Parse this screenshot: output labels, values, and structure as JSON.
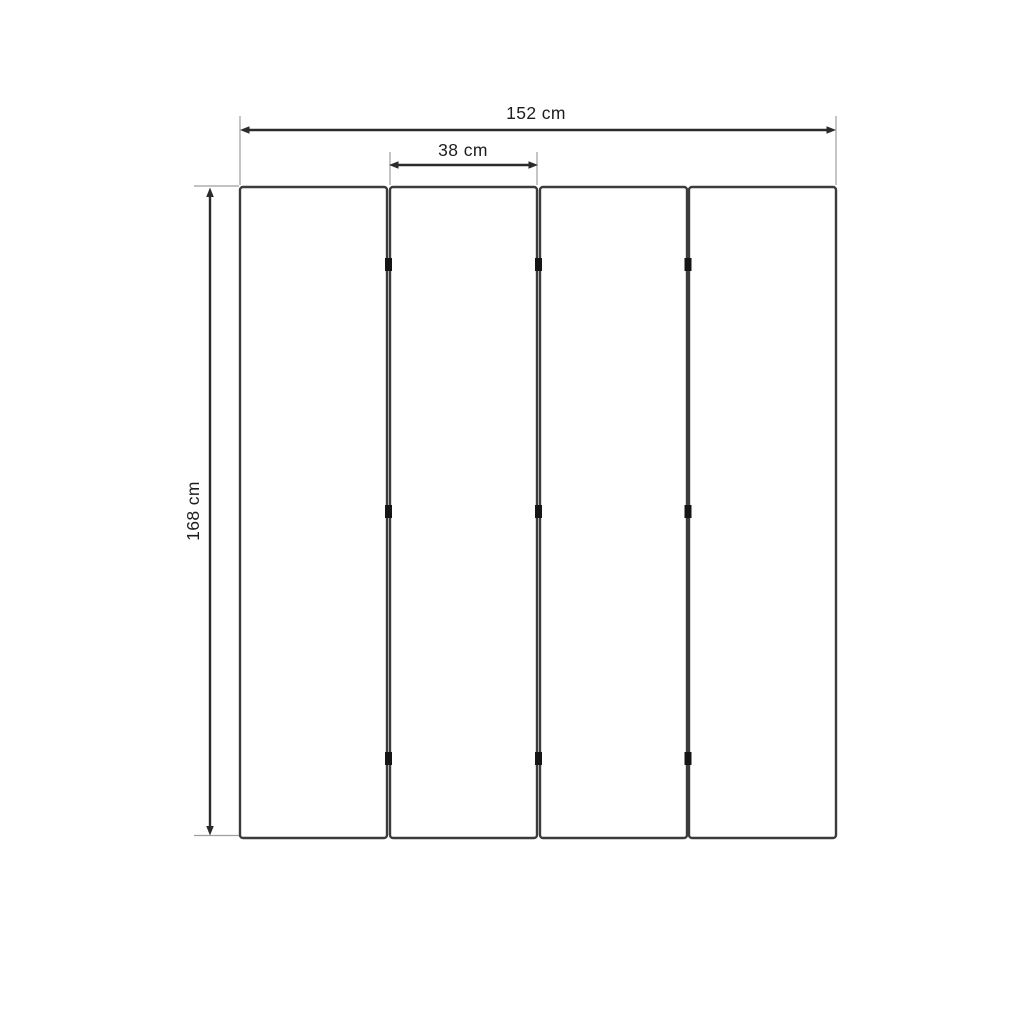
{
  "diagram": {
    "kind": "dimensioned-drawing",
    "panel_count": 4,
    "hinge_rows_per_gap": 3,
    "labels": {
      "total_width": "152 cm",
      "panel_width": "38 cm",
      "height": "168 cm"
    },
    "values_cm": {
      "total_width": 152,
      "panel_width": 38,
      "height": 168
    },
    "colors": {
      "background": "#ffffff",
      "panel_fill": "#ffffff",
      "panel_border": "#3c3c3c",
      "dimension_line": "#2b2b2b",
      "extension_line": "#9e9e9e",
      "hinge": "#151515",
      "text": "#1d1d1d"
    }
  }
}
